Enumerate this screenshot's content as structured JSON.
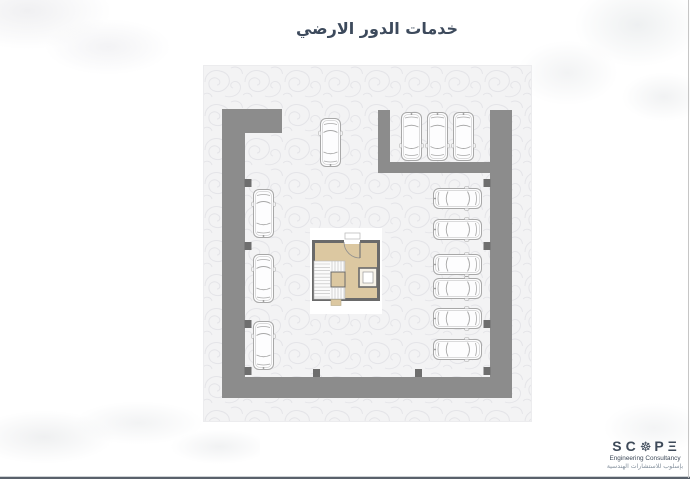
{
  "slide": {
    "title": "خدمات الدور الارضي",
    "title_color": "#3d4a5c"
  },
  "footer": {
    "brand": {
      "l1": "S",
      "l2": "C",
      "gear": "☸",
      "l3": "P",
      "l4": "Ξ"
    },
    "tagline_en": "Engineering Consultancy",
    "tagline_ar": "بإسلوب للاستشارات الهندسية",
    "color": "#3e4a59",
    "tagline_ar_color": "#828e9b"
  },
  "chrome": {
    "bottom_line_color": "#59616b",
    "right_line_color": "#c6c6c6"
  },
  "floorplan": {
    "paper": {
      "x": 203,
      "y": 65,
      "w": 329,
      "h": 357,
      "bg": "#f3f3f4",
      "swirl": "#e4e4e8",
      "edge": "#ececee"
    },
    "wall_color": "#8c8c8c",
    "pilaster_color": "#6e6e6e",
    "pilaster_size": {
      "w": 7,
      "h": 8
    },
    "walls": [
      {
        "name": "wall-top-left-stub",
        "x": 19,
        "y": 44,
        "w": 60,
        "h": 24
      },
      {
        "name": "wall-left",
        "x": 19,
        "y": 44,
        "w": 23,
        "h": 289
      },
      {
        "name": "wall-bottom",
        "x": 19,
        "y": 312,
        "w": 290,
        "h": 21
      },
      {
        "name": "wall-right",
        "x": 287,
        "y": 45,
        "w": 22,
        "h": 288
      },
      {
        "name": "wall-bay-left",
        "x": 175,
        "y": 45,
        "w": 12,
        "h": 63
      },
      {
        "name": "wall-bay-bottom",
        "x": 175,
        "y": 97,
        "w": 112,
        "h": 11
      }
    ],
    "pilasters": [
      {
        "x": 41.5,
        "y": 114
      },
      {
        "x": 41.5,
        "y": 177
      },
      {
        "x": 41.5,
        "y": 255
      },
      {
        "x": 41.5,
        "y": 302
      },
      {
        "x": 280.5,
        "y": 114
      },
      {
        "x": 280.5,
        "y": 177
      },
      {
        "x": 280.5,
        "y": 255
      },
      {
        "x": 280.5,
        "y": 302
      },
      {
        "x": 110,
        "y": 304
      },
      {
        "x": 212,
        "y": 304
      }
    ],
    "core": {
      "backdrop": {
        "x": 107,
        "y": 163,
        "w": 72,
        "h": 86
      },
      "outer": {
        "x": 109,
        "y": 175,
        "w": 68,
        "h": 61
      },
      "wall_color": "#6a6a6a",
      "fill": "#dcc8a1",
      "door_gap": {
        "x1": 141,
        "x2": 157
      },
      "stair": {
        "x": 111,
        "y": 196,
        "w": 31,
        "h": 38,
        "notch": {
          "x": 128,
          "y": 207,
          "w": 14,
          "h": 15
        }
      },
      "elevator": {
        "x": 156,
        "y": 203,
        "w": 18,
        "h": 19
      },
      "bottom_stub": {
        "x": 128,
        "y": 234.5,
        "w": 10,
        "h": 6
      }
    },
    "car_style": {
      "stroke": "#a8a8a8",
      "inner": "#cfcfcf",
      "fill": "#fdfdfe",
      "len": 51,
      "wid": 23
    },
    "cars": [
      {
        "x": 116,
        "y": 52,
        "dir": "up"
      },
      {
        "x": 197,
        "y": 46,
        "dir": "down"
      },
      {
        "x": 223,
        "y": 46,
        "dir": "down"
      },
      {
        "x": 249,
        "y": 46,
        "dir": "down"
      },
      {
        "x": 49,
        "y": 123,
        "dir": "up"
      },
      {
        "x": 49,
        "y": 188,
        "dir": "up"
      },
      {
        "x": 49,
        "y": 255,
        "dir": "up"
      },
      {
        "x": 229,
        "y": 122,
        "dir": "right"
      },
      {
        "x": 229,
        "y": 153,
        "dir": "right"
      },
      {
        "x": 229,
        "y": 188,
        "dir": "right"
      },
      {
        "x": 229,
        "y": 212,
        "dir": "right"
      },
      {
        "x": 229,
        "y": 242,
        "dir": "right"
      },
      {
        "x": 229,
        "y": 273,
        "dir": "right"
      }
    ]
  }
}
